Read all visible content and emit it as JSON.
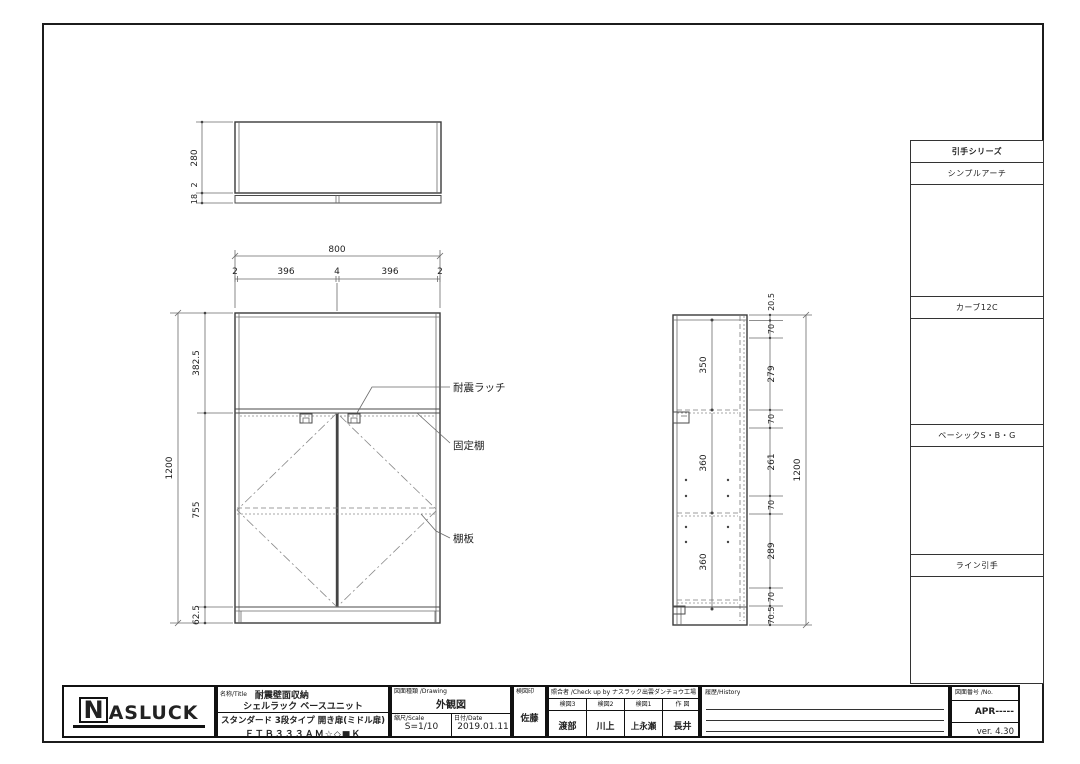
{
  "views": {
    "top": {
      "h280": "280",
      "g2": "2",
      "g18": "18"
    },
    "front": {
      "w800": "800",
      "c1": "2",
      "c2": "396",
      "c3": "4",
      "c4": "396",
      "c5": "2",
      "h1": "382.5",
      "h2": "755",
      "h3": "62.5",
      "total": "1200",
      "label_latch": "耐震ラッチ",
      "label_fixed": "固定棚",
      "label_shelf": "棚板"
    },
    "side": {
      "c1": "20.5",
      "c2": "70",
      "c3": "279",
      "c4": "70",
      "c5": "261",
      "c6": "70",
      "c7": "289",
      "c8": "70",
      "c9": "70.5",
      "i1": "350",
      "i2": "360",
      "i3": "360",
      "total": "1200"
    }
  },
  "handles": {
    "series_title": "引手シリーズ",
    "s1": {
      "title": "シンプルアーチ",
      "w": "40",
      "o": "27.5",
      "l": "153"
    },
    "s2": {
      "title": "カーブ12C",
      "w": "40",
      "o": "19",
      "l": "162"
    },
    "s3": {
      "title": "ベーシックS・B・G",
      "w": "40",
      "o": "15",
      "l": "200"
    },
    "s4": {
      "title": "ライン引手",
      "w": "134"
    }
  },
  "title_block": {
    "logo_n": "N",
    "logo_rest": "ASLUCK",
    "name_label": "名称/Title",
    "name1": "耐震壁面収納",
    "name2": "シェルラック  ベースユニット",
    "name3": "スタンダード 3段タイプ 開き扉(ミドル扉)",
    "name4": "ＦＴＢ３３３ＡＭ☆◇■Ｋ",
    "drawing_label": "図面種類 /Drawing",
    "drawing_type": "外観図",
    "scale_label": "縮尺/Scale",
    "scale": "S=1/10",
    "date_label": "日付/Date",
    "date": "2019.01.11",
    "stamp_label": "検図印",
    "stamp": "佐藤",
    "check_header": "照合者 /Check up by ナスラック出雲ダンチョウ工場",
    "check1_label": "検図3",
    "check1": "渡部",
    "check2_label": "検図2",
    "check2": "川上",
    "check3_label": "検図1",
    "check3": "上永瀬",
    "check4_label": "作 図",
    "check4": "長井",
    "history_label": "履歴/History",
    "no_label": "図面番号 /No.",
    "no": "APR-----",
    "version": "ver. 4.30"
  }
}
